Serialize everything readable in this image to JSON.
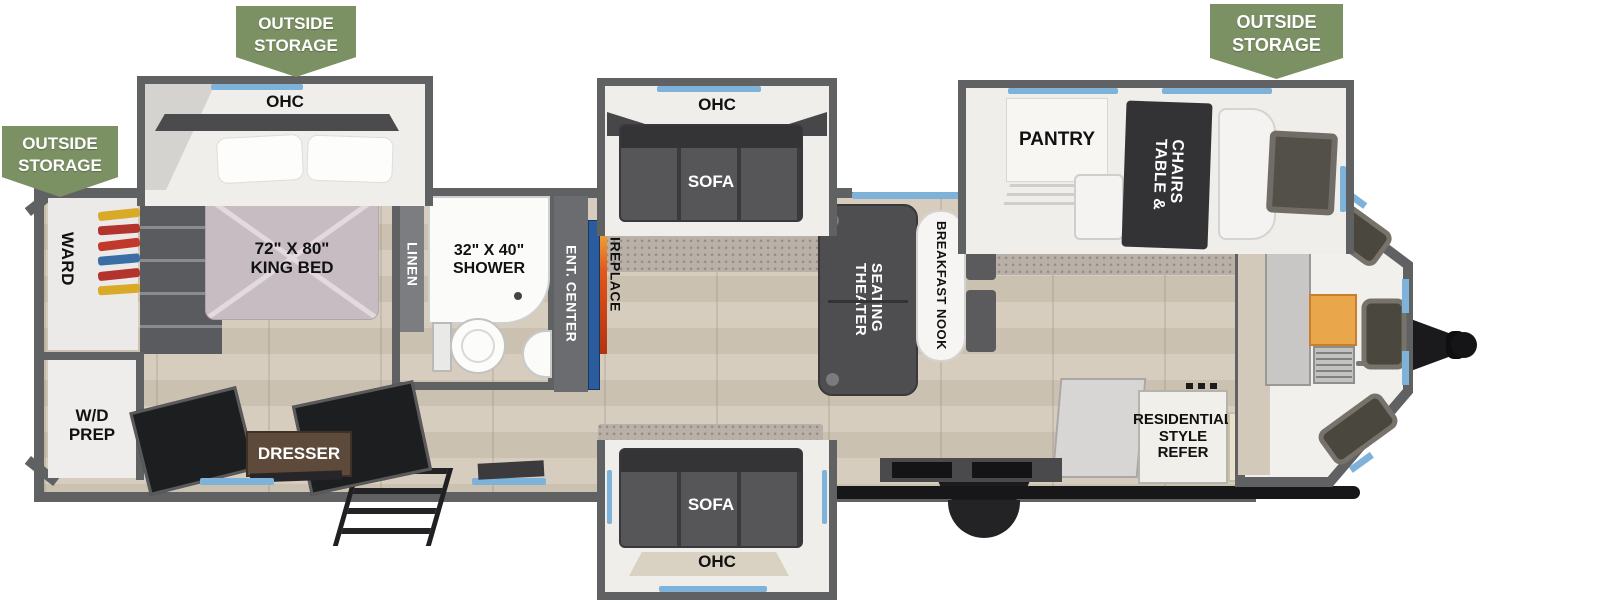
{
  "banners": [
    {
      "id": "rear-left",
      "text": "OUTSIDE\nSTORAGE"
    },
    {
      "id": "bedroom-top",
      "text": "OUTSIDE\nSTORAGE"
    },
    {
      "id": "front-top",
      "text": "OUTSIDE\nSTORAGE"
    }
  ],
  "rooms": {
    "bedroom": {
      "ohc": "OHC",
      "bed": "72\" X 80\"\nKING BED",
      "ward": "WARD",
      "wd_prep": "W/D\nPREP",
      "dresser": "DRESSER"
    },
    "bath": {
      "linen": "LINEN",
      "shower": "32\" X 40\"\nSHOWER"
    },
    "living": {
      "ent_center": "ENT. CENTER",
      "fireplace": "FIREPLACE",
      "ohc_top": "OHC",
      "sofa_top": "SOFA",
      "theater": "THEATER\nSEATING",
      "nook": "BREAKFAST NOOK",
      "sofa_bottom": "SOFA",
      "ohc_bottom": "OHC"
    },
    "kitchen": {
      "pantry": "PANTRY",
      "table": "TABLE &\nCHAIRS",
      "refer": "RESIDENTIAL\nSTYLE\nREFER",
      "micro": "MICRO"
    }
  },
  "colors": {
    "banner_green": "#7b9164",
    "wall_gray": "#5f6163",
    "accent_blue": "#7fb2d9",
    "floor_wood": "#d0c6b6",
    "bed_mauve": "#c7bcc1",
    "fireplace_orange": "#e2571b",
    "tv_blue": "#2a5c9e",
    "dark_furniture": "#4c4b4d"
  }
}
